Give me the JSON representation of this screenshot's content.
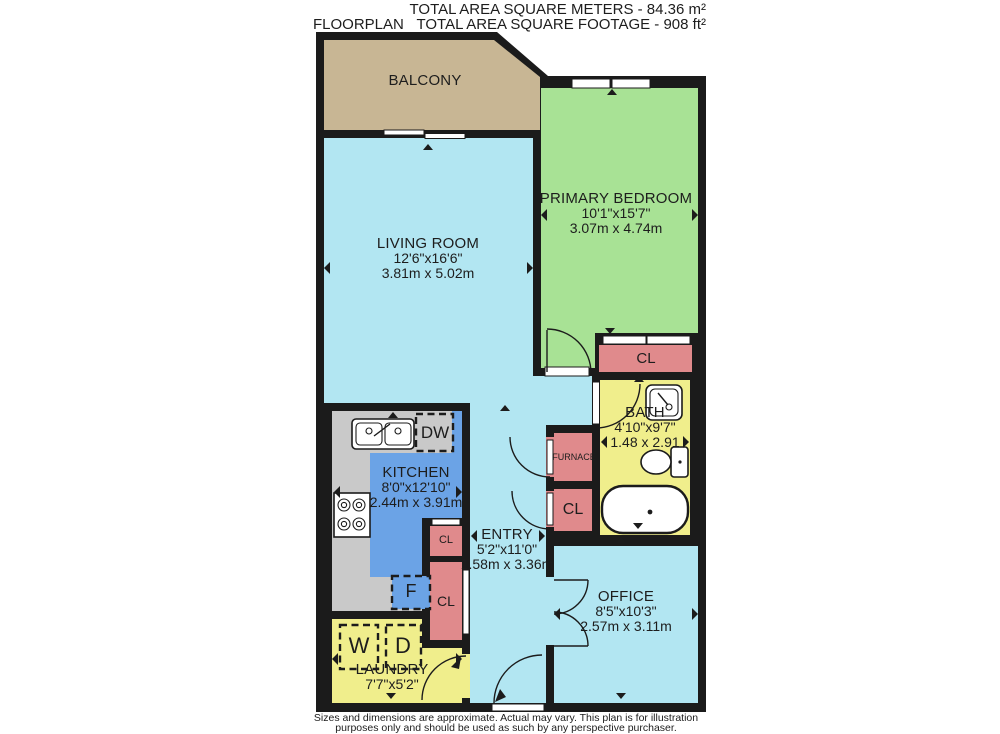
{
  "header": {
    "title": "FLOORPLAN",
    "total_area_meters": "TOTAL AREA SQUARE METERS - 84.36 m²",
    "total_area_feet": "TOTAL AREA SQUARE FOOTAGE - 908 ft²"
  },
  "rooms": {
    "balcony": {
      "name": "BALCONY"
    },
    "living_room": {
      "name": "LIVING ROOM",
      "dims_imperial": "12'6\"x16'6\"",
      "dims_metric": "3.81m x 5.02m"
    },
    "primary_bedroom": {
      "name": "PRIMARY BEDROOM",
      "dims_imperial": "10'1\"x15'7\"",
      "dims_metric": "3.07m x 4.74m"
    },
    "kitchen": {
      "name": "KITCHEN",
      "dims_imperial": "8'0\"x12'10\"",
      "dims_metric": "2.44m x 3.91m"
    },
    "bath": {
      "name": "BATH",
      "dims_imperial": "4'10\"x9'7\"",
      "dims_metric": "1.48 x 2.91"
    },
    "entry": {
      "name": "ENTRY",
      "dims_imperial": "5'2\"x11'0\"",
      "dims_metric": "1.58m x 3.36m"
    },
    "office": {
      "name": "OFFICE",
      "dims_imperial": "8'5\"x10'3\"",
      "dims_metric": "2.57m x 3.11m"
    },
    "laundry": {
      "name": "LAUNDRY",
      "dims_imperial": "7'7\"x5'2\""
    },
    "furnace": {
      "name": "FURNACE"
    }
  },
  "labels": {
    "closet": "CL",
    "dishwasher": "DW",
    "fridge": "F",
    "washer": "W",
    "dryer": "D"
  },
  "footer": {
    "line1": "Sizes and dimensions are approximate. Actual may vary. This plan is for illustration",
    "line2": "purposes only and should be used as such by any perspective purchaser."
  },
  "colors": {
    "wall": "#1b1b1b",
    "balcony": "#c8b694",
    "floor_light": "#b2e6f2",
    "bedroom": "#a8e295",
    "kitchen": "#6ba3e6",
    "bath": "#f0ee8c",
    "closet": "#e08a8c",
    "counter": "#c9c9c9"
  }
}
